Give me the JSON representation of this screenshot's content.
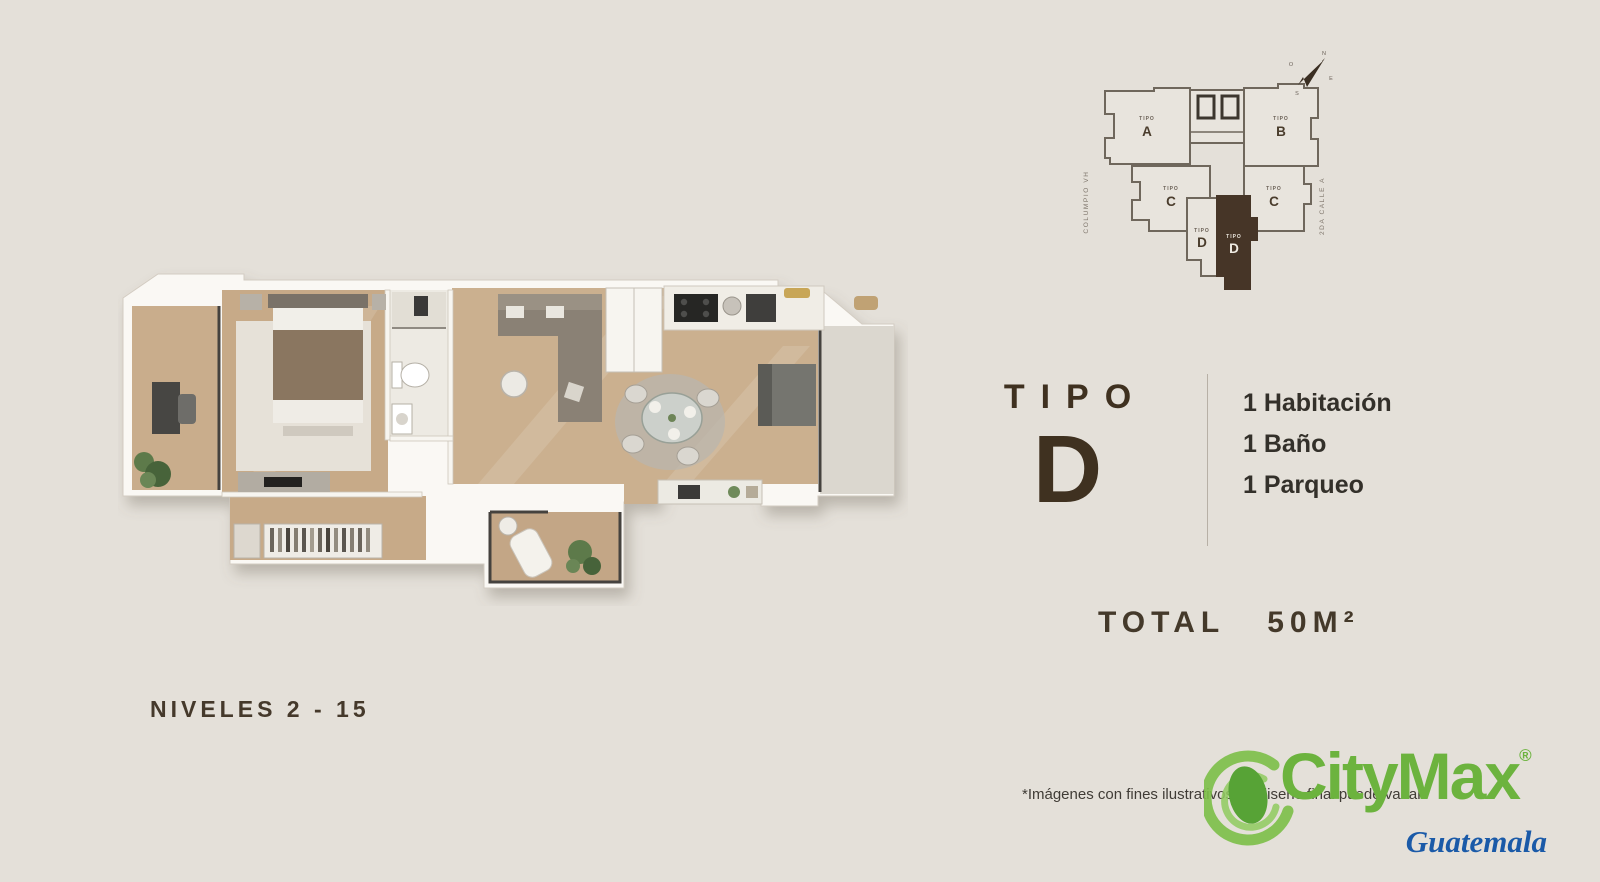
{
  "canvas": {
    "background": "#e4e0d9"
  },
  "site_plan": {
    "street_left": "COLUMPIO VH",
    "street_right": "2DA CALLE A",
    "compass": {
      "n": "N",
      "s": "S",
      "e": "E",
      "o": "O"
    },
    "units": [
      {
        "small": "TIPO",
        "letter": "A",
        "highlighted": false
      },
      {
        "small": "TIPO",
        "letter": "B",
        "highlighted": false
      },
      {
        "small": "TIPO",
        "letter": "C",
        "highlighted": false
      },
      {
        "small": "TIPO",
        "letter": "C",
        "highlighted": false
      },
      {
        "small": "TIPO",
        "letter": "D",
        "highlighted": false
      },
      {
        "small": "TIPO",
        "letter": "D",
        "highlighted": true
      }
    ]
  },
  "unit_info": {
    "type_label": "TIPO",
    "type_letter": "D",
    "features": [
      "1 Habitación",
      "1 Baño",
      "1 Parqueo"
    ],
    "total_label": "TOTAL",
    "total_value": "50M²"
  },
  "levels_label": "NIVELES 2 - 15",
  "disclaimer": "*Imágenes con fines ilustrativos. El diseño final puede variar.",
  "brand": {
    "name": "CityMax",
    "registered": "®",
    "region": "Guatemala"
  },
  "colors": {
    "text_brown": "#3f3120",
    "brand_green": "#6cb33e",
    "brand_blue": "#1a5aa8",
    "unit_highlight": "#463527",
    "wood_floor": "#c9ad8c"
  }
}
